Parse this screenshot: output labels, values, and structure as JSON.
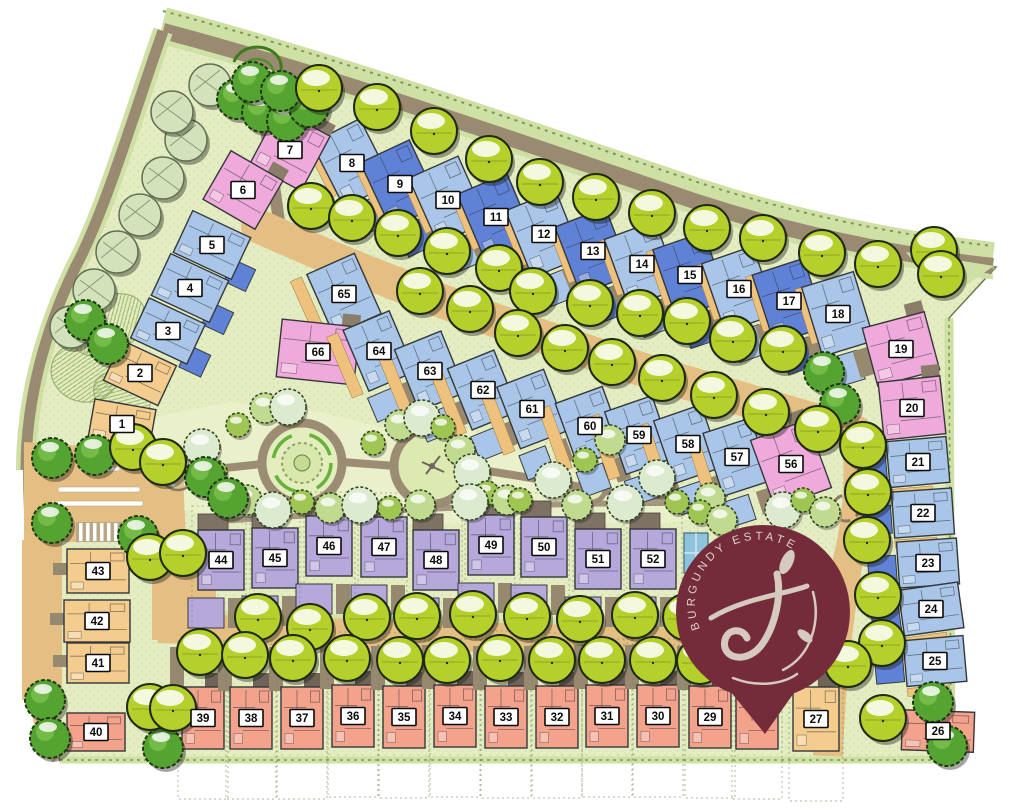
{
  "meta": {
    "title": "BURGUNDY ESTATE",
    "type": "residential estate site development plan"
  },
  "logo": {
    "title": "BURGUNDY ESTATE",
    "monogram": "J",
    "pin_color": "#742c3b",
    "text_color": "#dcd3c7",
    "cx": 763,
    "cy": 612,
    "r": 87,
    "tip_y": 733
  },
  "colors": {
    "site_green": "#e4ecc2",
    "park_green": "#eaf1ca",
    "road_gray": "#9a8a72",
    "road_tan": "#e4be82",
    "hedge_pale": "#cfe0a4",
    "tree_lime": "#b5cf2b",
    "tree_dark": "#55a432",
    "tree_pale": "#d4e2bc",
    "unit_types": {
      "lb": "#a9c6e8",
      "mb": "#6082d6",
      "pk": "#efaadb",
      "pu": "#b7a8dc",
      "sa": "#f3a28c",
      "ye": "#f3cc8e"
    }
  },
  "unit_fields": [
    "number",
    "type",
    "x",
    "y",
    "w",
    "h",
    "rot",
    "row"
  ],
  "units": [
    [
      8,
      "lb",
      352,
      163,
      54,
      72,
      -27,
      "top"
    ],
    [
      9,
      "mb",
      400,
      184,
      54,
      72,
      -25,
      "top"
    ],
    [
      10,
      "lb",
      448,
      200,
      54,
      72,
      -24,
      "top"
    ],
    [
      11,
      "mb",
      496,
      217,
      54,
      72,
      -23,
      "top"
    ],
    [
      12,
      "lb",
      544,
      234,
      54,
      72,
      -22,
      "top"
    ],
    [
      13,
      "mb",
      593,
      251,
      54,
      72,
      -21,
      "top"
    ],
    [
      14,
      "lb",
      642,
      264,
      54,
      72,
      -20,
      "top"
    ],
    [
      15,
      "mb",
      690,
      275,
      54,
      72,
      -19,
      "top"
    ],
    [
      16,
      "lb",
      739,
      289,
      54,
      72,
      -19,
      "top"
    ],
    [
      17,
      "mb",
      789,
      301,
      54,
      72,
      -18,
      "top"
    ],
    [
      18,
      "lb",
      838,
      314,
      54,
      72,
      -17,
      "top"
    ],
    [
      7,
      "pk",
      290,
      150,
      58,
      62,
      28,
      "plain"
    ],
    [
      6,
      "pk",
      243,
      190,
      60,
      56,
      30,
      "plain"
    ],
    [
      5,
      "lb",
      212,
      245,
      64,
      46,
      25,
      "leftcol"
    ],
    [
      4,
      "lb",
      190,
      288,
      64,
      46,
      25,
      "leftcol"
    ],
    [
      3,
      "lb",
      168,
      331,
      62,
      44,
      25,
      "leftcol"
    ],
    [
      2,
      "ye",
      140,
      373,
      60,
      44,
      25,
      "leftcol"
    ],
    [
      1,
      "ye",
      122,
      424,
      62,
      40,
      10,
      "leftcol"
    ],
    [
      65,
      "lb",
      344,
      294,
      52,
      66,
      -24,
      "mid"
    ],
    [
      66,
      "pk",
      318,
      352,
      78,
      58,
      6,
      "plain"
    ],
    [
      64,
      "lb",
      379,
      351,
      50,
      66,
      -23,
      "mid"
    ],
    [
      63,
      "lb",
      430,
      371,
      50,
      66,
      -22,
      "mid"
    ],
    [
      62,
      "lb",
      483,
      390,
      50,
      66,
      -22,
      "mid"
    ],
    [
      61,
      "lb",
      532,
      409,
      50,
      66,
      -21,
      "mid"
    ],
    [
      60,
      "lb",
      590,
      426,
      50,
      66,
      -20,
      "mid"
    ],
    [
      59,
      "lb",
      639,
      435,
      50,
      66,
      -19,
      "mid"
    ],
    [
      58,
      "lb",
      688,
      444,
      50,
      66,
      -19,
      "mid"
    ],
    [
      57,
      "lb",
      737,
      457,
      50,
      66,
      -18,
      "mid"
    ],
    [
      56,
      "pk",
      791,
      464,
      60,
      72,
      -20,
      "plain"
    ],
    [
      19,
      "pk",
      901,
      349,
      64,
      60,
      -15,
      "plain"
    ],
    [
      20,
      "pk",
      912,
      408,
      62,
      58,
      -6,
      "plain"
    ],
    [
      21,
      "lb",
      918,
      462,
      60,
      46,
      -5,
      "rightcol"
    ],
    [
      22,
      "lb",
      923,
      513,
      60,
      46,
      -4,
      "rightcol"
    ],
    [
      23,
      "lb",
      928,
      563,
      60,
      46,
      -4,
      "rightcol"
    ],
    [
      24,
      "lb",
      931,
      609,
      60,
      46,
      -8,
      "rightcol"
    ],
    [
      25,
      "lb",
      935,
      661,
      60,
      46,
      -5,
      "rightcol"
    ],
    [
      26,
      "sa",
      938,
      731,
      72,
      40,
      2,
      "plain"
    ],
    [
      44,
      "pu",
      221,
      560,
      46,
      60,
      0,
      "purple"
    ],
    [
      45,
      "pu",
      275,
      558,
      46,
      60,
      0,
      "purple"
    ],
    [
      46,
      "pu",
      329,
      546,
      46,
      60,
      0,
      "purple"
    ],
    [
      47,
      "pu",
      384,
      547,
      46,
      60,
      0,
      "purple"
    ],
    [
      48,
      "pu",
      436,
      560,
      46,
      60,
      0,
      "purple"
    ],
    [
      49,
      "pu",
      491,
      545,
      46,
      60,
      0,
      "purple"
    ],
    [
      50,
      "pu",
      544,
      547,
      46,
      60,
      0,
      "purple"
    ],
    [
      51,
      "pu",
      598,
      559,
      46,
      60,
      0,
      "purple"
    ],
    [
      52,
      "pu",
      653,
      559,
      46,
      60,
      0,
      "purple"
    ],
    [
      39,
      "sa",
      203,
      718,
      42,
      62,
      0,
      "salmon"
    ],
    [
      38,
      "sa",
      251,
      718,
      42,
      62,
      0,
      "salmon"
    ],
    [
      37,
      "sa",
      302,
      718,
      42,
      62,
      0,
      "salmon"
    ],
    [
      36,
      "sa",
      353,
      716,
      42,
      62,
      0,
      "salmon"
    ],
    [
      35,
      "sa",
      404,
      717,
      42,
      62,
      0,
      "salmon"
    ],
    [
      34,
      "sa",
      455,
      716,
      42,
      62,
      0,
      "salmon"
    ],
    [
      33,
      "sa",
      506,
      717,
      42,
      62,
      0,
      "salmon"
    ],
    [
      32,
      "sa",
      557,
      717,
      42,
      62,
      0,
      "salmon"
    ],
    [
      31,
      "sa",
      607,
      716,
      42,
      62,
      0,
      "salmon"
    ],
    [
      30,
      "sa",
      658,
      716,
      42,
      62,
      0,
      "salmon"
    ],
    [
      29,
      "sa",
      710,
      717,
      42,
      62,
      0,
      "salmon"
    ],
    [
      null,
      "sa",
      757,
      718,
      42,
      62,
      0,
      "salmon"
    ],
    [
      27,
      "ye",
      816,
      719,
      46,
      64,
      0,
      "salmon"
    ],
    [
      40,
      "sa",
      96,
      732,
      58,
      38,
      0,
      "plain"
    ],
    [
      41,
      "ye",
      98,
      663,
      62,
      40,
      0,
      "leftY"
    ],
    [
      42,
      "ye",
      97,
      621,
      66,
      42,
      0,
      "leftY"
    ],
    [
      43,
      "ye",
      98,
      571,
      62,
      44,
      0,
      "leftY"
    ]
  ],
  "trees": {
    "lime": [
      [
        319,
        88
      ],
      [
        377,
        107
      ],
      [
        434,
        131
      ],
      [
        489,
        159
      ],
      [
        540,
        182
      ],
      [
        596,
        197
      ],
      [
        652,
        213
      ],
      [
        707,
        228
      ],
      [
        763,
        238
      ],
      [
        822,
        253
      ],
      [
        878,
        264
      ],
      [
        934,
        250
      ],
      [
        941,
        274
      ],
      [
        311,
        206
      ],
      [
        352,
        218
      ],
      [
        398,
        233
      ],
      [
        447,
        251
      ],
      [
        499,
        268
      ],
      [
        533,
        291
      ],
      [
        590,
        303
      ],
      [
        640,
        313
      ],
      [
        687,
        321
      ],
      [
        733,
        339
      ],
      [
        783,
        349
      ],
      [
        420,
        291
      ],
      [
        470,
        309
      ],
      [
        518,
        333
      ],
      [
        565,
        348
      ],
      [
        612,
        362
      ],
      [
        662,
        378
      ],
      [
        714,
        395
      ],
      [
        766,
        412
      ],
      [
        818,
        429
      ],
      [
        863,
        445
      ],
      [
        868,
        492
      ],
      [
        867,
        540
      ],
      [
        878,
        595
      ],
      [
        882,
        643
      ],
      [
        883,
        718
      ],
      [
        258,
        617
      ],
      [
        310,
        627
      ],
      [
        367,
        617
      ],
      [
        417,
        616
      ],
      [
        473,
        614
      ],
      [
        527,
        616
      ],
      [
        580,
        619
      ],
      [
        635,
        615
      ],
      [
        686,
        617
      ],
      [
        200,
        652
      ],
      [
        245,
        655
      ],
      [
        293,
        658
      ],
      [
        347,
        658
      ],
      [
        400,
        660
      ],
      [
        447,
        660
      ],
      [
        500,
        658
      ],
      [
        552,
        660
      ],
      [
        602,
        660
      ],
      [
        653,
        660
      ],
      [
        700,
        661
      ],
      [
        848,
        664
      ],
      [
        150,
        557
      ],
      [
        183,
        553
      ],
      [
        150,
        707
      ],
      [
        173,
        708
      ],
      [
        133,
        447
      ],
      [
        163,
        462
      ]
    ],
    "dark": [
      [
        237,
        99
      ],
      [
        262,
        112
      ],
      [
        287,
        121
      ],
      [
        309,
        107
      ],
      [
        252,
        82
      ],
      [
        281,
        91
      ],
      [
        85,
        320
      ],
      [
        108,
        344
      ],
      [
        52,
        458
      ],
      [
        95,
        455
      ],
      [
        52,
        523
      ],
      [
        138,
        536
      ],
      [
        205,
        477
      ],
      [
        228,
        498
      ],
      [
        824,
        372
      ],
      [
        840,
        404
      ],
      [
        933,
        702
      ],
      [
        947,
        746
      ],
      [
        45,
        700
      ],
      [
        50,
        738
      ],
      [
        163,
        748
      ]
    ],
    "pale": [
      [
        210,
        85
      ],
      [
        186,
        140
      ],
      [
        163,
        178
      ],
      [
        140,
        215
      ],
      [
        117,
        252
      ],
      [
        94,
        290
      ],
      [
        71,
        327
      ],
      [
        172,
        112
      ]
    ],
    "park": [
      [
        238,
        425
      ],
      [
        265,
        408
      ],
      [
        288,
        407
      ],
      [
        373,
        443
      ],
      [
        400,
        425
      ],
      [
        422,
        418
      ],
      [
        443,
        427
      ],
      [
        460,
        450
      ],
      [
        472,
        472
      ],
      [
        487,
        493
      ],
      [
        507,
        500
      ],
      [
        202,
        447
      ],
      [
        215,
        472
      ],
      [
        247,
        500
      ],
      [
        273,
        510
      ],
      [
        302,
        502
      ],
      [
        330,
        508
      ],
      [
        360,
        505
      ],
      [
        390,
        508
      ],
      [
        420,
        505
      ],
      [
        470,
        502
      ],
      [
        520,
        500
      ],
      [
        577,
        505
      ],
      [
        625,
        503
      ],
      [
        677,
        502
      ],
      [
        710,
        498
      ],
      [
        657,
        478
      ],
      [
        700,
        512
      ],
      [
        722,
        520
      ],
      [
        783,
        510
      ],
      [
        803,
        500
      ],
      [
        825,
        512
      ],
      [
        553,
        480
      ],
      [
        585,
        460
      ],
      [
        610,
        440
      ]
    ]
  },
  "features": {
    "pool": {
      "x": 684,
      "y": 533,
      "w": 24,
      "h": 40
    },
    "roundabout_left": {
      "x": 178,
      "y": 473
    },
    "roundabout_right": {
      "x": 846,
      "y": 508
    },
    "park_circle_1": {
      "x": 302,
      "y": 463
    },
    "park_circle_2": {
      "x": 432,
      "y": 466
    },
    "park_circle_small": {
      "x": 592,
      "y": 489
    }
  }
}
